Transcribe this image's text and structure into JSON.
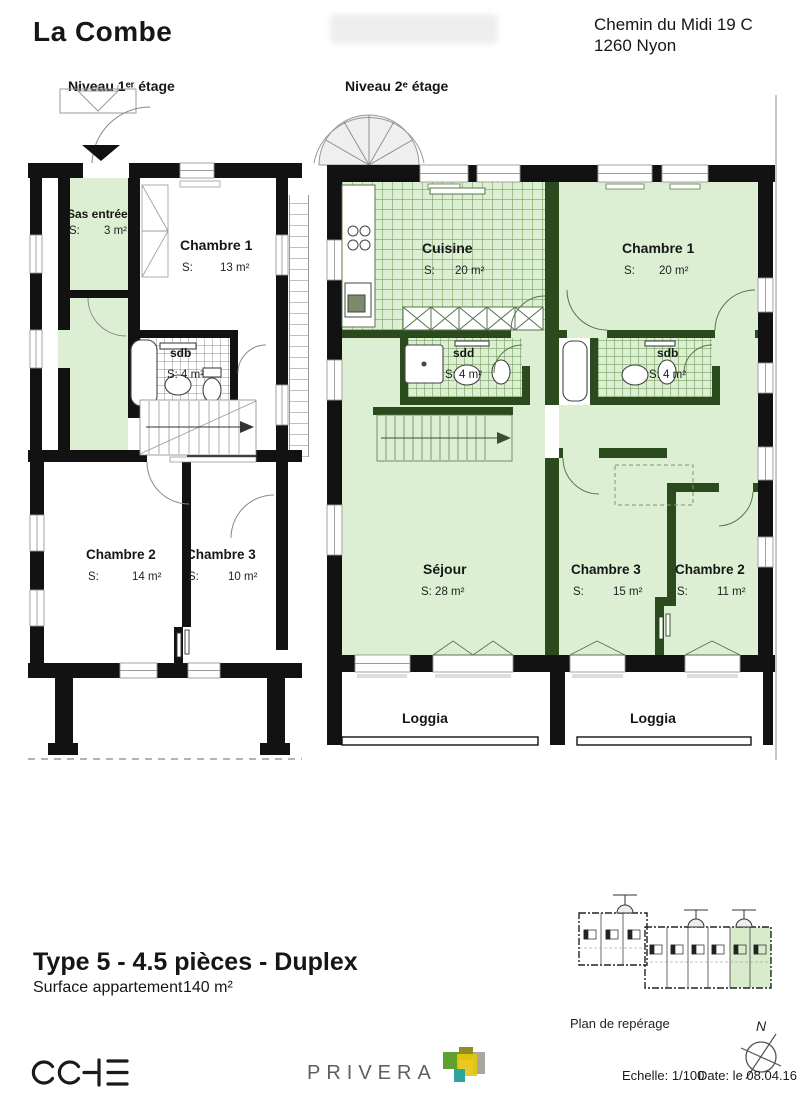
{
  "header": {
    "title": "La Combe",
    "address1": "Chemin du Midi 19 C",
    "address2": "1260 Nyon"
  },
  "plans": {
    "level1": {
      "label": "Niveau 1ᵉʳ étage",
      "rooms": {
        "sas": {
          "name": "Sas entrée",
          "s": "S:",
          "area": "3 m²"
        },
        "ch1": {
          "name": "Chambre 1",
          "s": "S:",
          "area": "13 m²"
        },
        "sdb": {
          "name": "sdb",
          "area": "S: 4 m²"
        },
        "ch2": {
          "name": "Chambre 2",
          "s": "S:",
          "area": "14 m²"
        },
        "ch3": {
          "name": "Chambre 3",
          "s": "S:",
          "area": "10 m²"
        }
      }
    },
    "level2": {
      "label": "Niveau 2ᵉ étage",
      "rooms": {
        "cuisine": {
          "name": "Cuisine",
          "s": "S:",
          "area": "20 m²"
        },
        "ch1": {
          "name": "Chambre 1",
          "s": "S:",
          "area": "20 m²"
        },
        "sdd": {
          "name": "sdd",
          "area": "S: 4 m²"
        },
        "sdb": {
          "name": "sdb",
          "area": "S: 4 m²"
        },
        "sejour": {
          "name": "Séjour",
          "area": "S: 28 m²"
        },
        "ch3": {
          "name": "Chambre 3",
          "s": "S:",
          "area": "15 m²"
        },
        "ch2": {
          "name": "Chambre 2",
          "s": "S:",
          "area": "11 m²"
        },
        "loggia_left": "Loggia",
        "loggia_right": "Loggia"
      }
    }
  },
  "footer": {
    "type_title": "Type 5 - 4.5 pièces - Duplex",
    "surface_label": "Surface appartement",
    "surface_value": "140 m²",
    "key_plan_label": "Plan de repérage",
    "scale": "Echelle: 1/100",
    "date": "Date: le 08.04.16",
    "north": "N"
  },
  "logos": {
    "cche": "CCHE",
    "privera": "PRIVERA"
  },
  "colors": {
    "room_green": "#dcefd3",
    "wall_dark_green": "#2b4a1d",
    "wall_black": "#121212",
    "key_plan_green": "#d8eccc"
  }
}
